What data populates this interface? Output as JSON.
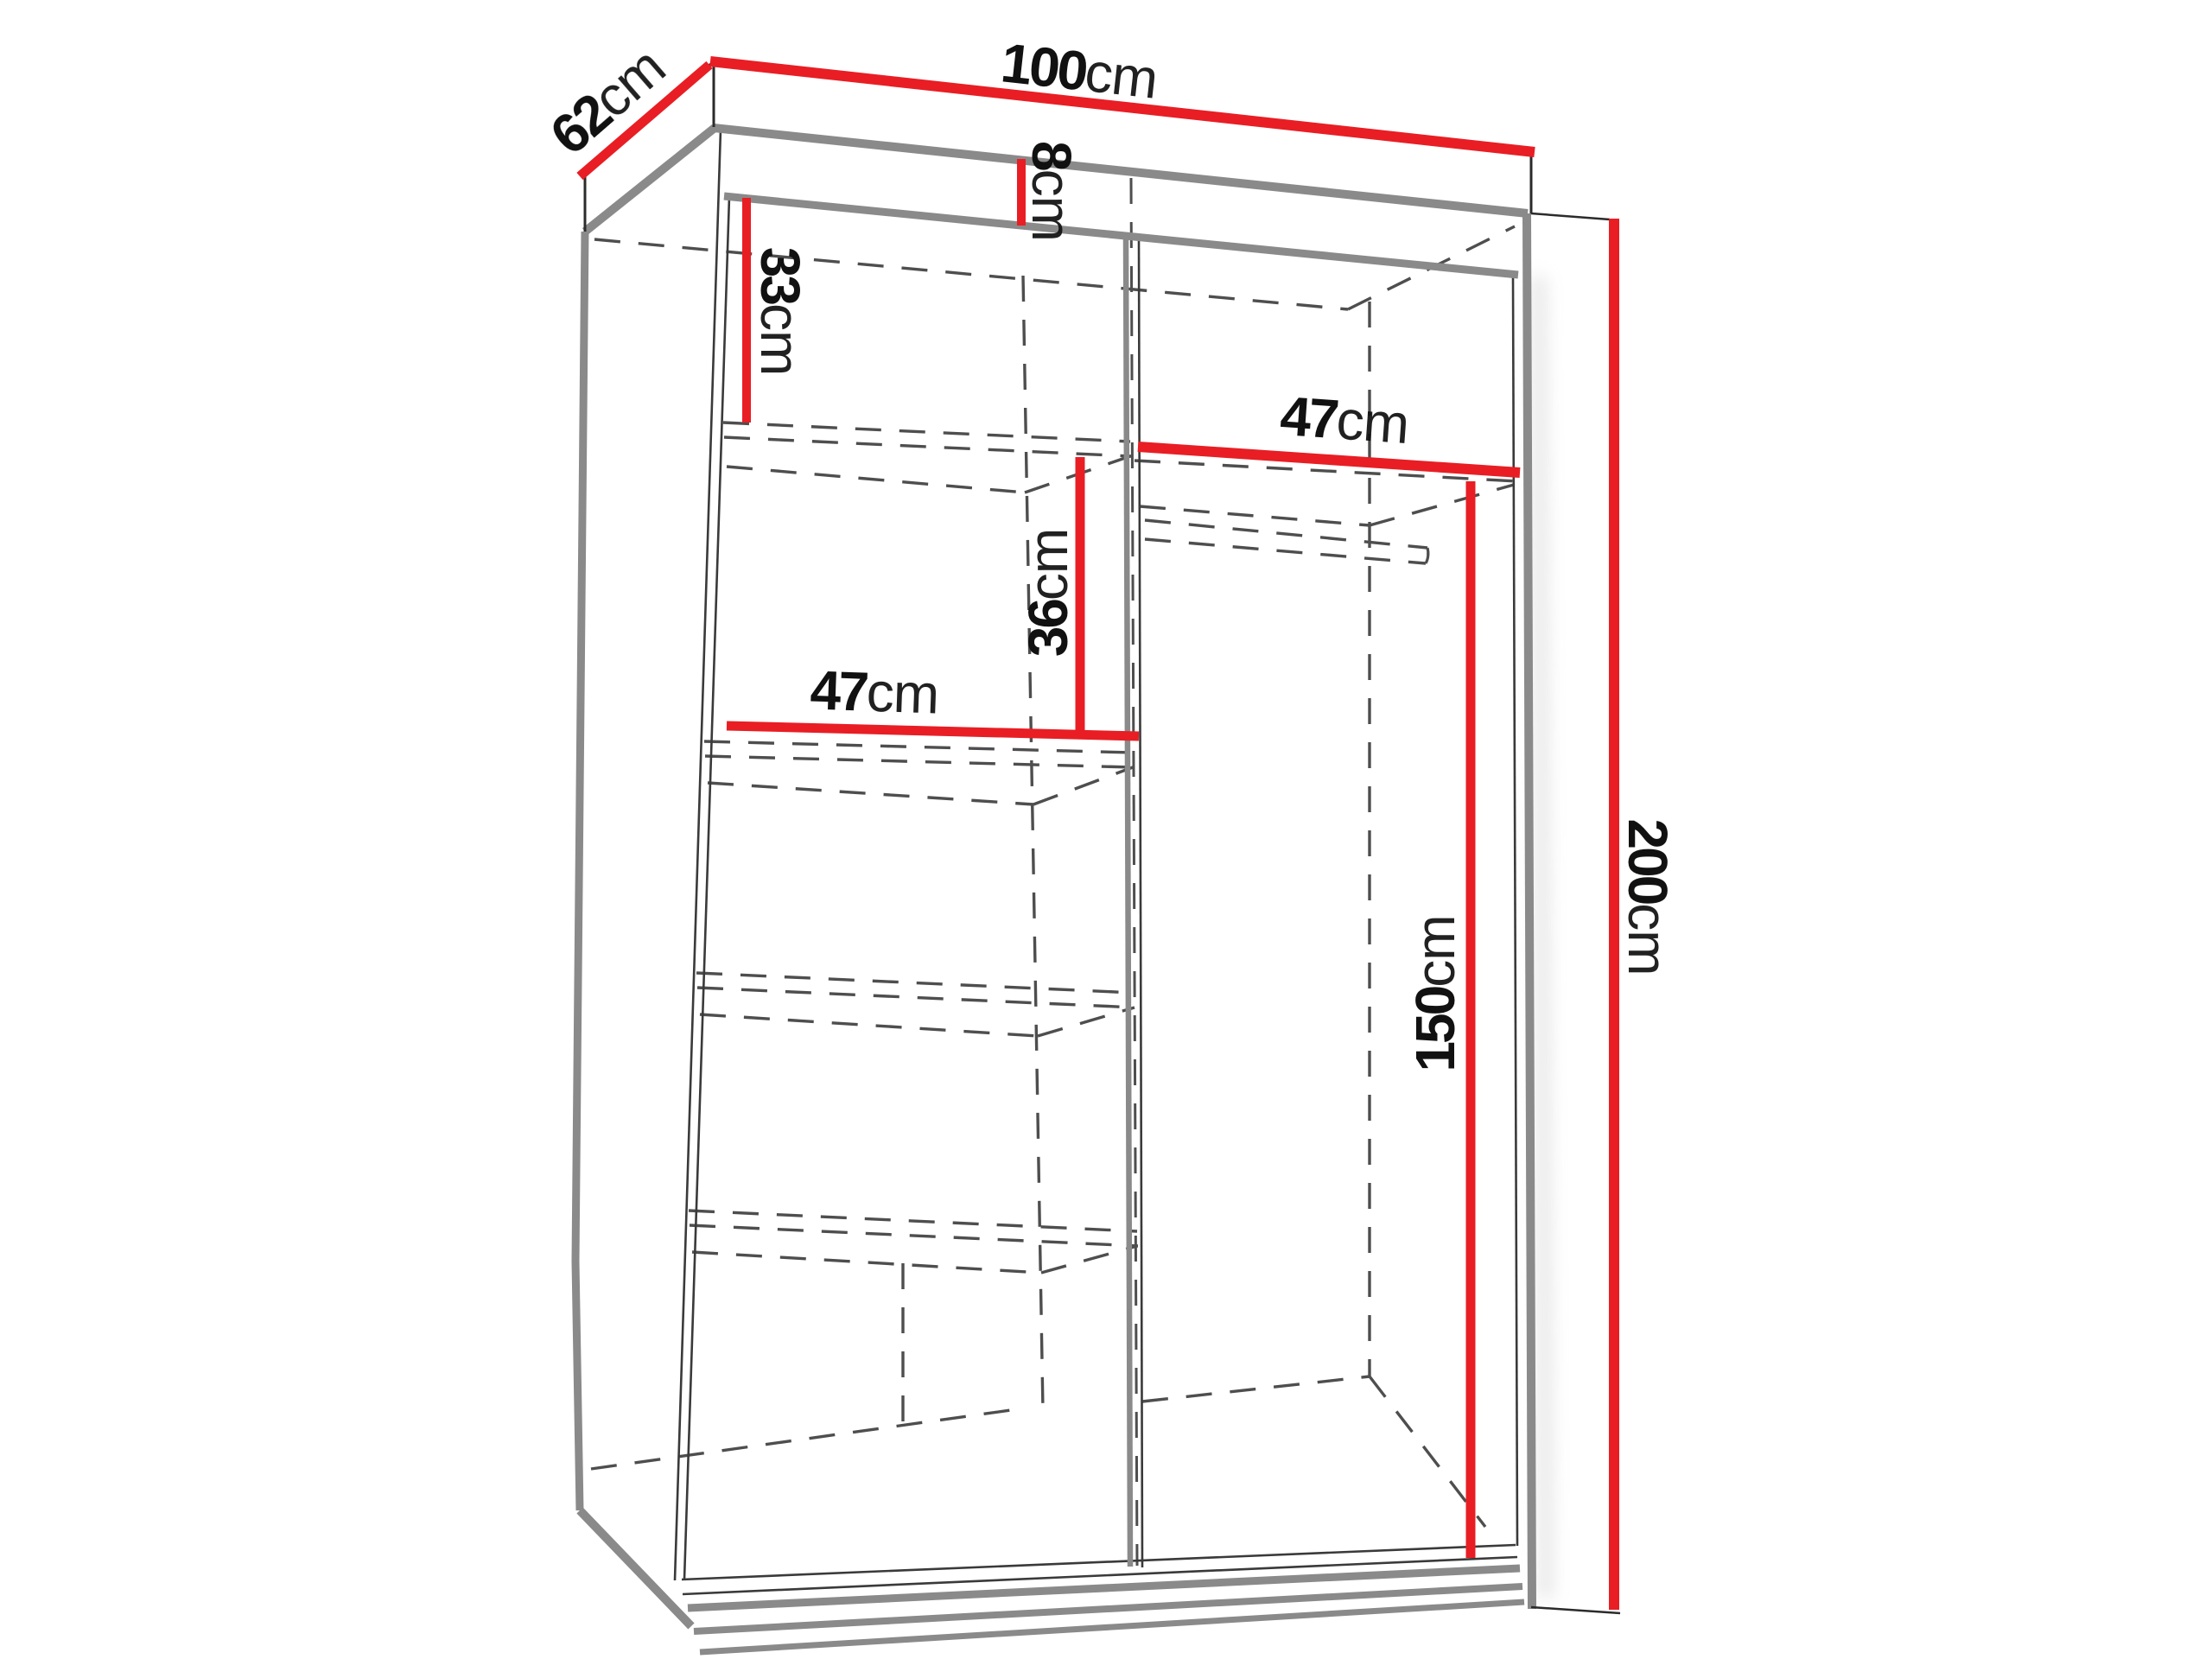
{
  "page": {
    "title": "Wardrobe interior dimensions diagram",
    "background": "#ffffff"
  },
  "colors": {
    "background": "#ffffff",
    "dimension_line": "#e81e24",
    "frame_gray": "#8a8a8a",
    "edge_dark": "#2b2b2b",
    "edge_thin": "#3a3a3a",
    "hidden_line": "#4e4e4e",
    "label_text": "#111111"
  },
  "dimensions": {
    "depth": {
      "value": "62",
      "unit": "cm"
    },
    "width": {
      "value": "100",
      "unit": "cm"
    },
    "top_rail": {
      "value": "8",
      "unit": "cm"
    },
    "upper_shelf_gap": {
      "value": "33",
      "unit": "cm"
    },
    "right_compartment_width": {
      "value": "47",
      "unit": "cm"
    },
    "middle_shelf_gap": {
      "value": "36",
      "unit": "cm"
    },
    "left_compartment_width": {
      "value": "47",
      "unit": "cm"
    },
    "hanging_space_height": {
      "value": "150",
      "unit": "cm"
    },
    "total_height": {
      "value": "200",
      "unit": "cm"
    }
  }
}
